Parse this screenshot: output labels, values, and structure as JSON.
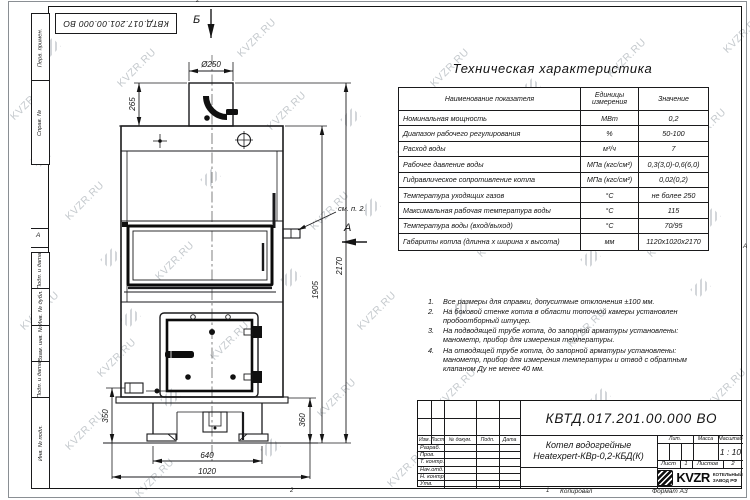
{
  "watermark": {
    "text": "KVZR.RU"
  },
  "stamp_top_left": "КВТД.017.201.00.000 ВО",
  "frame": {
    "left_labels": [
      "Перв. примен.",
      "Справ. №",
      "Подп. и дата",
      "Инв. № дубл.",
      "Взам. инв. №",
      "Подп. и дата",
      "Инв. № подл."
    ],
    "zone_left": "А",
    "zone_right": "А",
    "zone_top": "2",
    "zone_bottom_left": "2",
    "zone_bottom_right": "1"
  },
  "drawing": {
    "view_top": "Б",
    "view_side": "А",
    "note_ref": "см. п. 2.",
    "dims": {
      "flue_diameter": "Ø250",
      "flue_height": "265",
      "total_height": "2170",
      "body_height": "1905",
      "stub_height": "350",
      "base_height": "360",
      "base_width": "640",
      "overall_width": "1020"
    }
  },
  "spec_table": {
    "title": "Техническая характеристика",
    "headers": [
      "Наименование показателя",
      "Единицы измерения",
      "Значение"
    ],
    "rows": [
      [
        "Номинальная мощность",
        "МВт",
        "0,2"
      ],
      [
        "Диапазон рабочего регулирования",
        "%",
        "50-100"
      ],
      [
        "Расход воды",
        "м³/ч",
        "7"
      ],
      [
        "Рабочее давление воды",
        "МПа (кгс/см²)",
        "0,3(3,0)-0,6(6,0)"
      ],
      [
        "Гидравлическое сопротивление котла",
        "МПа (кгс/см²)",
        "0,02(0,2)"
      ],
      [
        "Температура уходящих газов",
        "°С",
        "не более 250"
      ],
      [
        "Максимальная рабочая температура воды",
        "°С",
        "115"
      ],
      [
        "Температура воды (вход/выход)",
        "°С",
        "70/95"
      ],
      [
        "Габариты котла (длинна х ширина х высота)",
        "мм",
        "1120х1020х2170"
      ]
    ]
  },
  "notes": [
    "Все размеры для справки, допуситмые отклонения ±100 мм.",
    "На боковой стенке котла в области топочной камеры установлен пробоотборный штуцер.",
    "На подводящей трубе котла, до запорной арматуры установлены: манометр, прибор для измерения температуры.",
    "На отводящей трубе котла, до запорной арматуры установлены: манометр, прибор для измерения температуры и отвод с обратным клапаном Ду не менее 40 мм."
  ],
  "title_block": {
    "doc_number": "КВТД.017.201.00.000 ВО",
    "product_name_line1": "Котел водогрейные",
    "product_name_line2": "Heatexpert-КВр-0,2-КБД(К)",
    "header_cols": [
      "Изм.",
      "Лист",
      "№ докум.",
      "Подп.",
      "Дата"
    ],
    "row_labels": [
      "Разраб.",
      "Пров.",
      "Т. контр.",
      "Нач.отд.",
      "Н. контр.",
      "Утв."
    ],
    "lit_label": "Лит.",
    "mass_label": "Масса",
    "scale_label": "Масштаб",
    "scale_value": "1 : 10",
    "sheet_label": "Лист",
    "sheet_value": "1",
    "sheets_label": "Листов",
    "sheets_value": "2",
    "logo_text": "KVZR",
    "logo_sub1": "КОТЕЛЬНЫЙ",
    "logo_sub2": "ЗАВОД РФ",
    "copied_label": "Копировал",
    "format_label": "Формат А3"
  }
}
